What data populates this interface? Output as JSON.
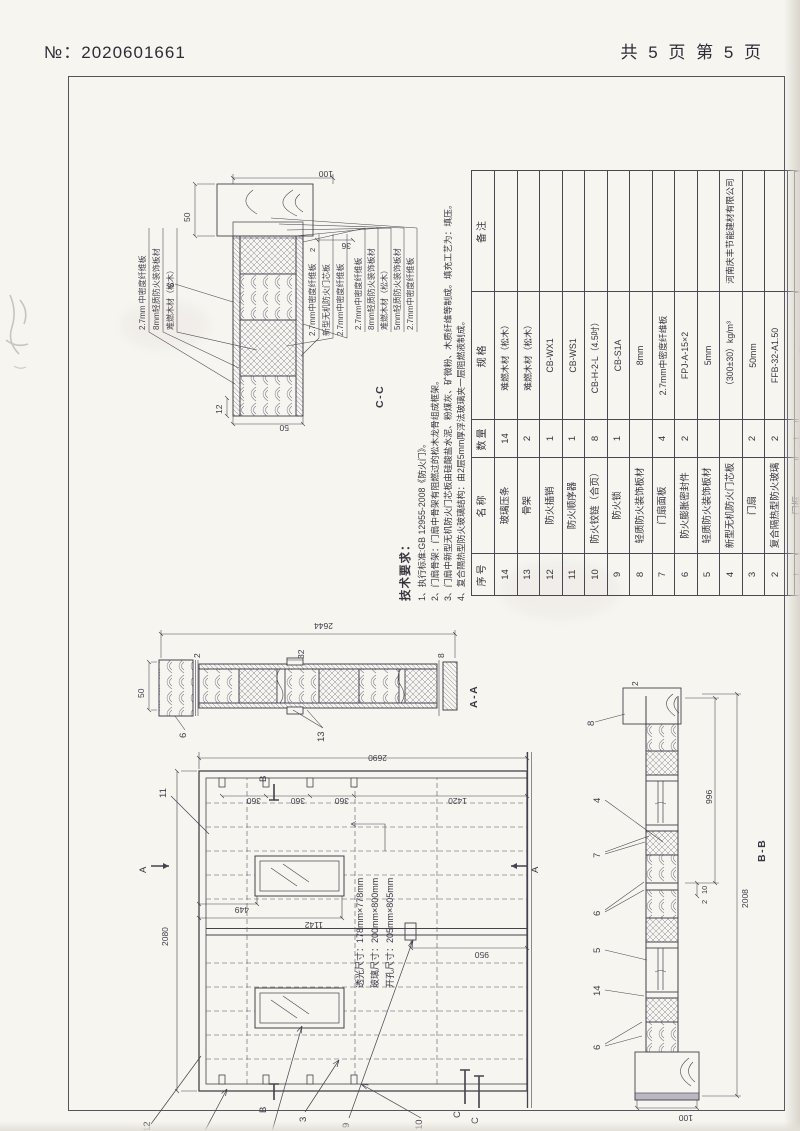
{
  "page": {
    "doc_no": "№：2020601661",
    "page_info": "共 5 页 第 5 页"
  },
  "tech_notes": {
    "title": "技术要求：",
    "items": [
      "1、执行标准:GB 12955-2008《防火门》。",
      "2、门扇骨架：门扇中骨架有阻燃过的松木龙骨组成框架。",
      "3、门扇中新型无机防火门芯板由硅酸盐水泥、粉煤灰、矿微粉、木质纤维等制成。填充工艺为：填压。",
      "4、复合隔热型防火玻璃结构：由2层5mm厚浮法玻璃夹一层阻燃液制成。"
    ]
  },
  "glass_notes": [
    "透光尺寸：178mm×778mm",
    "玻璃尺寸：200mm×800mm",
    "开孔尺寸：205mm×805mm"
  ],
  "parts_table": {
    "headers": [
      "序号",
      "名称",
      "数量",
      "规格",
      "备注"
    ],
    "rows": [
      [
        "14",
        "玻璃压条",
        "14",
        "难燃木材（松木）",
        ""
      ],
      [
        "13",
        "骨架",
        "2",
        "难燃木材（松木）",
        ""
      ],
      [
        "12",
        "防火插销",
        "1",
        "CB-WX1",
        ""
      ],
      [
        "11",
        "防火顺序器",
        "1",
        "CB-WS1",
        ""
      ],
      [
        "10",
        "防火铰链（合页）",
        "8",
        "CB-H-2-L（4.5吋）",
        ""
      ],
      [
        "9",
        "防火锁",
        "1",
        "CB-S1A",
        ""
      ],
      [
        "8",
        "轻质防火装饰板材",
        "",
        "8mm",
        ""
      ],
      [
        "7",
        "门扇面板",
        "4",
        "2.7mm中密度纤维板",
        ""
      ],
      [
        "6",
        "防火膨胀密封件",
        "2",
        "FPJ-A-15×2",
        ""
      ],
      [
        "5",
        "轻质防火装饰板材",
        "",
        "5mm",
        ""
      ],
      [
        "4",
        "新型无机防火门芯板",
        "",
        "（300±30）kg/m³",
        "河南庆丰节能建材有限公司"
      ],
      [
        "3",
        "门扇",
        "2",
        "50mm",
        ""
      ],
      [
        "2",
        "复合隔热型防火玻璃",
        "2",
        "FFB-32-A1.50",
        ""
      ],
      [
        "1",
        "门框",
        "1",
        "",
        ""
      ]
    ]
  },
  "title_block": {
    "approve": "批准",
    "design": "设计",
    "check": "审核",
    "grade_label": "级别",
    "grade": "A1.50（甲级）",
    "code_label": "代号",
    "code": "MFM-2127-bd5 A1.50(甲级)-2",
    "material_label": "材料",
    "material": "木  质",
    "product": "木质隔热防火门",
    "company": "河南聚泰实业有限公司"
  },
  "annotations": [
    {
      "t": "2080",
      "x": 240,
      "y": 24
    },
    {
      "t": "2690",
      "x": 424,
      "y": 250,
      "r": -90
    },
    {
      "t": "360",
      "x": 381,
      "y": 124,
      "r": -90
    },
    {
      "t": "360",
      "x": 381,
      "y": 168,
      "r": -90
    },
    {
      "t": "360",
      "x": 381,
      "y": 212,
      "r": -90
    },
    {
      "t": "1420",
      "x": 381,
      "y": 330,
      "r": -90
    },
    {
      "t": "449",
      "x": 272,
      "y": 112,
      "r": -90
    },
    {
      "t": "1142",
      "x": 257,
      "y": 186,
      "r": -90
    },
    {
      "t": "950",
      "x": 227,
      "y": 352,
      "r": -90
    },
    {
      "t": "12",
      "x": 54,
      "y": 6,
      "c": "callout",
      "n": "callout-label"
    },
    {
      "t": "11",
      "x": 388,
      "y": 22,
      "c": "callout",
      "n": "callout-label"
    },
    {
      "t": "1",
      "x": 34,
      "y": 56,
      "c": "callout",
      "n": "callout-label"
    },
    {
      "t": "2",
      "x": 34,
      "y": 126,
      "c": "callout",
      "n": "callout-label"
    },
    {
      "t": "3",
      "x": 64,
      "y": 162,
      "c": "callout",
      "n": "callout-label"
    },
    {
      "t": "9",
      "x": 58,
      "y": 205,
      "c": "callout",
      "n": "callout-label"
    },
    {
      "t": "10",
      "x": 56,
      "y": 278,
      "c": "callout",
      "n": "callout-label"
    },
    {
      "t": "A",
      "x": 313,
      "y": 2,
      "c": "callout",
      "n": "section-letter"
    },
    {
      "t": "A",
      "x": 313,
      "y": 394,
      "c": "callout",
      "n": "section-letter"
    },
    {
      "t": "B",
      "x": 73,
      "y": 122,
      "c": "callout",
      "n": "section-letter"
    },
    {
      "t": "B",
      "x": 404,
      "y": 122,
      "c": "callout",
      "n": "section-letter"
    },
    {
      "t": "C",
      "x": 68,
      "y": 316,
      "c": "callout",
      "n": "section-letter"
    },
    {
      "t": "C",
      "x": 62,
      "y": 334,
      "c": "callout",
      "n": "section-letter"
    },
    {
      "t": "50",
      "x": 488,
      "y": 0
    },
    {
      "t": "2",
      "x": 528,
      "y": 56
    },
    {
      "t": "32",
      "x": 527,
      "y": 160
    },
    {
      "t": "8",
      "x": 528,
      "y": 300
    },
    {
      "t": "13",
      "x": 444,
      "y": 180,
      "c": "callout",
      "n": "callout-label"
    },
    {
      "t": "6",
      "x": 448,
      "y": 42,
      "c": "callout",
      "n": "callout-label"
    },
    {
      "t": "2644",
      "x": 556,
      "y": 196,
      "r": -90
    },
    {
      "t": "A-A",
      "x": 478,
      "y": 332,
      "c": "view",
      "n": "view-label"
    },
    {
      "t": "100",
      "x": 64,
      "y": 556,
      "r": -90
    },
    {
      "t": "2",
      "x": 282,
      "y": 564,
      "s": "7.5"
    },
    {
      "t": "10",
      "x": 292,
      "y": 564,
      "s": "7.5"
    },
    {
      "t": "996",
      "x": 382,
      "y": 568
    },
    {
      "t": "2008",
      "x": 278,
      "y": 604
    },
    {
      "t": "2",
      "x": 500,
      "y": 494
    },
    {
      "t": "6",
      "x": 136,
      "y": 456,
      "c": "callout",
      "n": "callout-label"
    },
    {
      "t": "14",
      "x": 190,
      "y": 456,
      "c": "callout",
      "n": "callout-label"
    },
    {
      "t": "5",
      "x": 233,
      "y": 456,
      "c": "callout",
      "n": "callout-label"
    },
    {
      "t": "6",
      "x": 270,
      "y": 456,
      "c": "callout",
      "n": "callout-label"
    },
    {
      "t": "7",
      "x": 328,
      "y": 456,
      "c": "callout",
      "n": "callout-label"
    },
    {
      "t": "4",
      "x": 383,
      "y": 456,
      "c": "callout",
      "n": "callout-label"
    },
    {
      "t": "8",
      "x": 460,
      "y": 450,
      "c": "callout",
      "n": "callout-label"
    },
    {
      "t": "B-B",
      "x": 324,
      "y": 620,
      "c": "view",
      "n": "view-label"
    },
    {
      "t": "2.7mm 中密度纤维板",
      "x": 856,
      "y": 2,
      "c": "part",
      "n": "material-label"
    },
    {
      "t": "8mm轻质防火装饰板材",
      "x": 856,
      "y": 16,
      "c": "part",
      "n": "material-label"
    },
    {
      "t": "难燃木材（松木）",
      "x": 856,
      "y": 30,
      "c": "part",
      "n": "material-label"
    },
    {
      "t": "2.7mm中密度纤维板",
      "x": 850,
      "y": 172,
      "c": "part",
      "n": "material-label"
    },
    {
      "t": "新型无机防火门芯板",
      "x": 850,
      "y": 186,
      "c": "part",
      "n": "material-label"
    },
    {
      "t": "2.7mm中密度纤维板",
      "x": 850,
      "y": 200,
      "c": "part",
      "n": "material-label"
    },
    {
      "t": "2.7mm中密度纤维板",
      "x": 856,
      "y": 218,
      "c": "part",
      "n": "material-label"
    },
    {
      "t": "8mm轻质防火装饰板材",
      "x": 856,
      "y": 231,
      "c": "part",
      "n": "material-label"
    },
    {
      "t": "难燃木材（松木）",
      "x": 856,
      "y": 244,
      "c": "part",
      "n": "material-label"
    },
    {
      "t": "5mm轻质防火装饰板材",
      "x": 856,
      "y": 257,
      "c": "part",
      "n": "material-label"
    },
    {
      "t": "2.7mm中密度纤维板",
      "x": 856,
      "y": 270,
      "c": "part",
      "n": "material-label"
    },
    {
      "t": "50",
      "x": 754,
      "y": 152,
      "r": -90
    },
    {
      "t": "12",
      "x": 772,
      "y": 78
    },
    {
      "t": "50",
      "x": 964,
      "y": 46
    },
    {
      "t": "2",
      "x": 934,
      "y": 172,
      "s": "7.5"
    },
    {
      "t": "36",
      "x": 936,
      "y": 214,
      "r": -90
    },
    {
      "t": "100",
      "x": 1008,
      "y": 196,
      "r": -90
    },
    {
      "t": "6",
      "x": 898,
      "y": 30,
      "c": "callout",
      "n": "callout-label"
    },
    {
      "t": "C-C",
      "x": 778,
      "y": 238,
      "c": "view",
      "n": "view-label"
    }
  ]
}
